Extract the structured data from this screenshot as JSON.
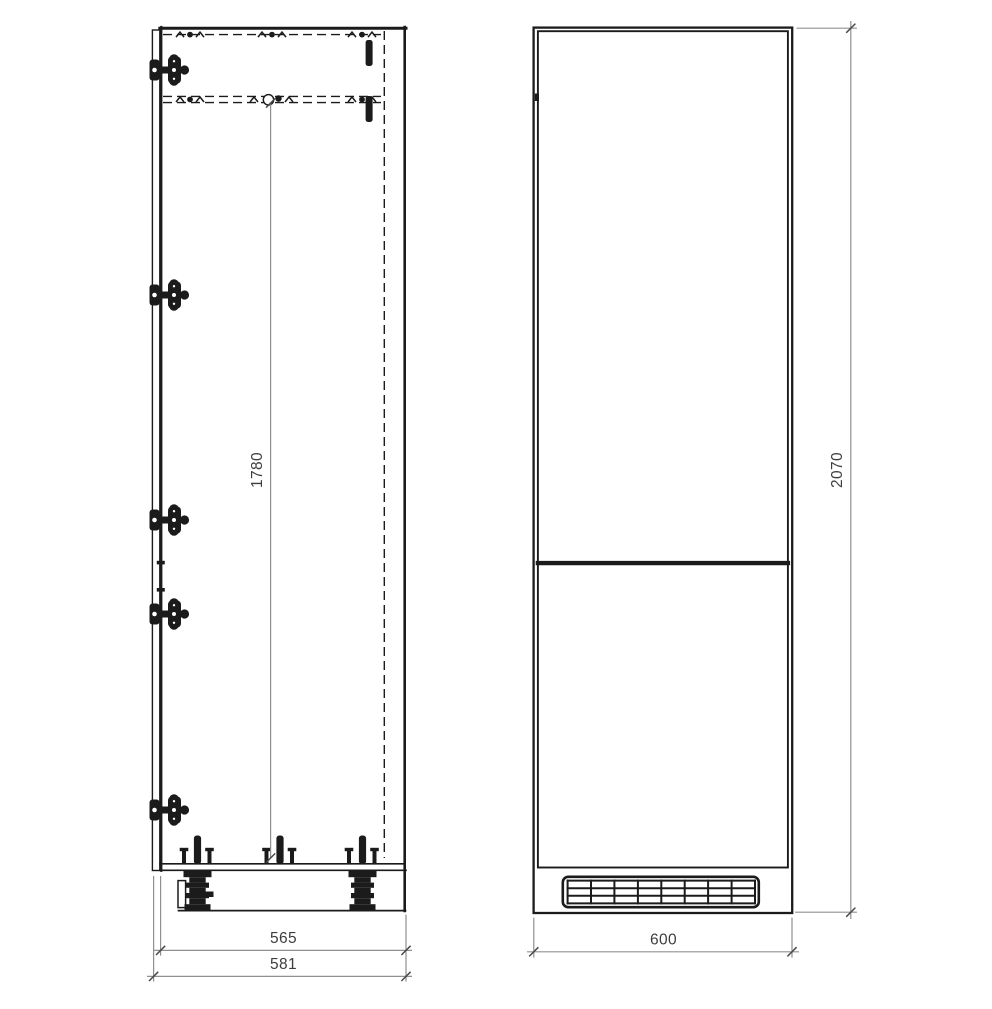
{
  "drawing": {
    "type": "technical-cad-drawing",
    "subject": "tall-fridge-housing-cabinet",
    "views": [
      "side-section-view",
      "front-elevation-view"
    ]
  },
  "colors": {
    "line": "#1b1b1b",
    "dim_line": "#909090",
    "dim_tick": "#4a4a4a",
    "dim_text": "#3d3d3d",
    "background": "#ffffff"
  },
  "side_view": {
    "dim_niche_height": "1780",
    "dim_depth_carcass": "565",
    "dim_depth_total": "581"
  },
  "front_view": {
    "dim_width": "600",
    "dim_height": "2070"
  }
}
